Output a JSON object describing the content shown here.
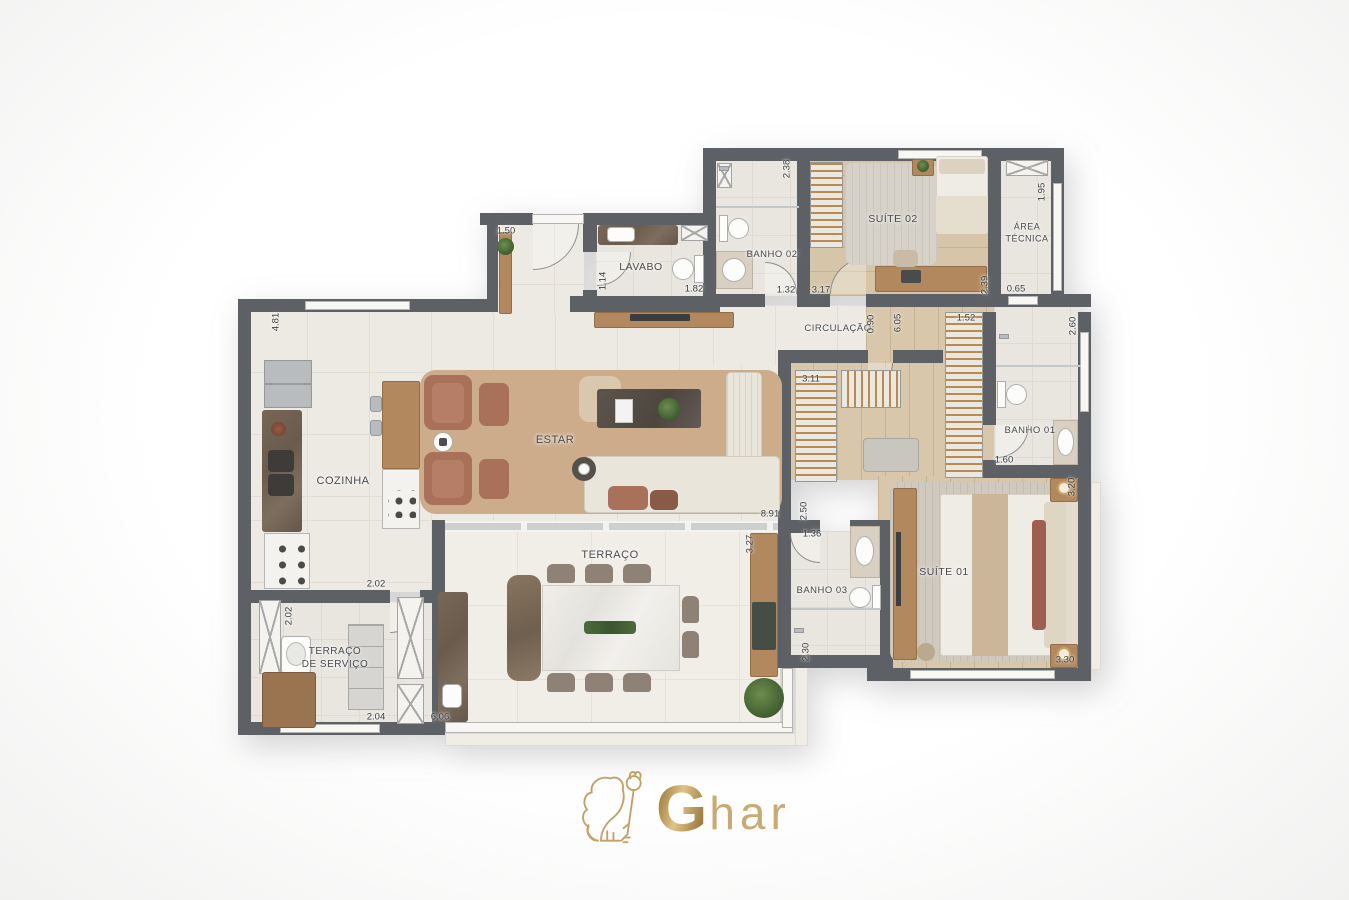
{
  "logo": {
    "initial": "G",
    "rest": "har"
  },
  "palette": {
    "wall": "#5d6165",
    "gold": "#c2a05f",
    "tile_social": "#edeae3",
    "tile_terrace": "#f1eee7",
    "wood_floor": "#d8c7aa",
    "rug_living": "#cdac8b",
    "sofa_cream": "#eae5da",
    "armchair_terracotta": "#a9715a"
  },
  "rooms": [
    {
      "id": "cozinha",
      "label": "COZINHA",
      "x": 343,
      "y": 481,
      "size": 11
    },
    {
      "id": "estar",
      "label": "ESTAR",
      "x": 555,
      "y": 440,
      "size": 11
    },
    {
      "id": "lavabo",
      "label": "LAVABO",
      "x": 641,
      "y": 268,
      "size": 10.5
    },
    {
      "id": "banho-02",
      "label": "BANHO 02",
      "x": 772,
      "y": 255,
      "size": 9.5
    },
    {
      "id": "suite-02",
      "label": "SUÍTE 02",
      "x": 893,
      "y": 220,
      "size": 10.5
    },
    {
      "id": "area-tecnica",
      "label": "ÁREA\nTÉCNICA",
      "x": 1027,
      "y": 233,
      "size": 9
    },
    {
      "id": "circulacao",
      "label": "CIRCULAÇÃO",
      "x": 838,
      "y": 329,
      "size": 9.5
    },
    {
      "id": "banho-01",
      "label": "BANHO 01",
      "x": 1030,
      "y": 431,
      "size": 9.5
    },
    {
      "id": "suite-01",
      "label": "SUÍTE 01",
      "x": 944,
      "y": 573,
      "size": 10.5
    },
    {
      "id": "banho-03",
      "label": "BANHO 03",
      "x": 822,
      "y": 591,
      "size": 9.5
    },
    {
      "id": "terraco",
      "label": "TERRAÇO",
      "x": 610,
      "y": 555,
      "size": 11
    },
    {
      "id": "terraco-servico",
      "label": "TERRAÇO\nDE SERVIÇO",
      "x": 335,
      "y": 658,
      "size": 10
    }
  ],
  "dimensions": [
    {
      "value": "1.50",
      "x": 506,
      "y": 231,
      "o": "h"
    },
    {
      "value": "1.14",
      "x": 603,
      "y": 281,
      "o": "v"
    },
    {
      "value": "1.82",
      "x": 694,
      "y": 289,
      "o": "h"
    },
    {
      "value": "2.38",
      "x": 787,
      "y": 169,
      "o": "v"
    },
    {
      "value": "1.32",
      "x": 786,
      "y": 290,
      "o": "h"
    },
    {
      "value": "3.17",
      "x": 821,
      "y": 290,
      "o": "h"
    },
    {
      "value": "2.39",
      "x": 985,
      "y": 285,
      "o": "v"
    },
    {
      "value": "1.95",
      "x": 1042,
      "y": 192,
      "o": "v"
    },
    {
      "value": "0.65",
      "x": 1016,
      "y": 289,
      "o": "h"
    },
    {
      "value": "0.90",
      "x": 871,
      "y": 324,
      "o": "v"
    },
    {
      "value": "6.05",
      "x": 898,
      "y": 323,
      "o": "v"
    },
    {
      "value": "1.52",
      "x": 966,
      "y": 318,
      "o": "h"
    },
    {
      "value": "3.11",
      "x": 811,
      "y": 379,
      "o": "h"
    },
    {
      "value": "2.60",
      "x": 1073,
      "y": 326,
      "o": "v"
    },
    {
      "value": "1.60",
      "x": 1004,
      "y": 460,
      "o": "h"
    },
    {
      "value": "4.81",
      "x": 276,
      "y": 322,
      "o": "v"
    },
    {
      "value": "2.02",
      "x": 376,
      "y": 584,
      "o": "h"
    },
    {
      "value": "2.02",
      "x": 289,
      "y": 616,
      "o": "v"
    },
    {
      "value": "2.04",
      "x": 376,
      "y": 717,
      "o": "h"
    },
    {
      "value": "6.06",
      "x": 440,
      "y": 717,
      "o": "h"
    },
    {
      "value": "8.91",
      "x": 770,
      "y": 514,
      "o": "h"
    },
    {
      "value": "3.27",
      "x": 750,
      "y": 544,
      "o": "v"
    },
    {
      "value": "2.50",
      "x": 804,
      "y": 511,
      "o": "v"
    },
    {
      "value": "1.36",
      "x": 812,
      "y": 534,
      "o": "h"
    },
    {
      "value": "2.30",
      "x": 806,
      "y": 652,
      "o": "v"
    },
    {
      "value": "3.20",
      "x": 1072,
      "y": 487,
      "o": "v"
    },
    {
      "value": "3.30",
      "x": 1065,
      "y": 660,
      "o": "h"
    }
  ]
}
